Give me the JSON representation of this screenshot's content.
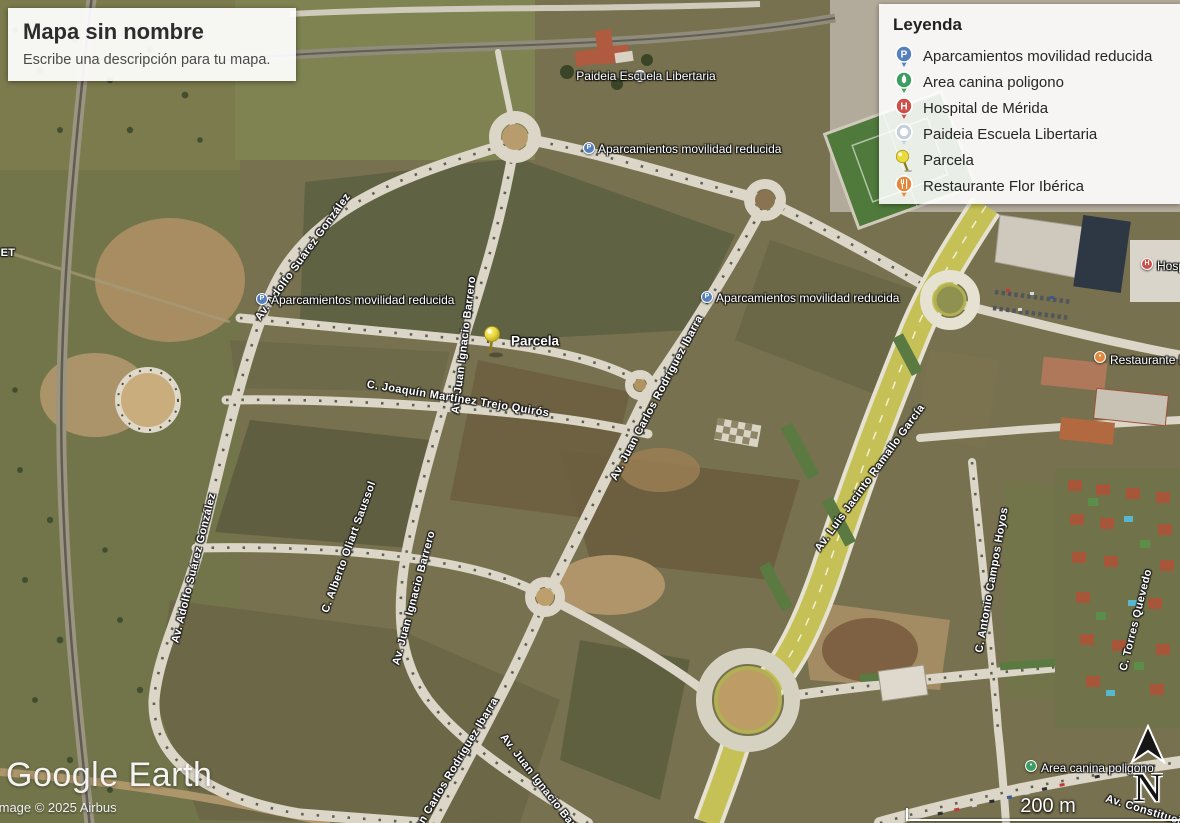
{
  "title_card": {
    "title": "Mapa sin nombre",
    "subtitle": "Escribe una descripción para tu mapa."
  },
  "legend": {
    "heading": "Leyenda",
    "items": [
      {
        "icon": "parking-marker",
        "color": "#5580bd",
        "label": "Aparcamientos movilidad reducida"
      },
      {
        "icon": "dog-park-marker",
        "color": "#3d9e63",
        "label": "Area canina poligono"
      },
      {
        "icon": "hospital-marker",
        "color": "#cc4f4a",
        "label": "Hospital de Mérida"
      },
      {
        "icon": "school-marker",
        "color": "#c2d0da",
        "label": "Paideia Escuela Libertaria"
      },
      {
        "icon": "pushpin",
        "color": "#ecd93c",
        "label": "Parcela"
      },
      {
        "icon": "restaurant-marker",
        "color": "#e2873b",
        "label": "Restaurante Flor Ibérica"
      }
    ]
  },
  "map_labels": {
    "poi": [
      {
        "text": "Paideia Escuela Libertaria",
        "marker": "school",
        "color": "#c2d0da",
        "glyph": "•",
        "mx": 640,
        "my": 76,
        "tx": 646,
        "ty": 76,
        "align": "center",
        "big": false
      },
      {
        "text": "Aparcamientos movilidad reducida",
        "marker": "parking",
        "color": "#5580bd",
        "glyph": "P",
        "mx": 589,
        "my": 148,
        "tx": 598,
        "ty": 149,
        "align": "left",
        "big": false
      },
      {
        "text": "Aparcamientos movilidad reducida",
        "marker": "parking",
        "color": "#5580bd",
        "glyph": "P",
        "mx": 262,
        "my": 299,
        "tx": 271,
        "ty": 300,
        "align": "left",
        "big": false
      },
      {
        "text": "Aparcamientos movilidad reducida",
        "marker": "parking",
        "color": "#5580bd",
        "glyph": "P",
        "mx": 707,
        "my": 297,
        "tx": 716,
        "ty": 298,
        "align": "left",
        "big": false
      },
      {
        "text": "Parcela",
        "marker": "pushpin",
        "color": "#ecd93c",
        "glyph": "",
        "mx": 490,
        "my": 343,
        "tx": 511,
        "ty": 341,
        "align": "left",
        "big": true
      },
      {
        "text": "Area canina poligono",
        "marker": "dog",
        "color": "#3d9e63",
        "glyph": "•",
        "mx": 1031,
        "my": 766,
        "tx": 1041,
        "ty": 768,
        "align": "left",
        "big": false
      },
      {
        "text": "Hospital de Mérida",
        "marker": "hospital",
        "color": "#cc4f4a",
        "glyph": "H",
        "mx": 1147,
        "my": 264,
        "tx": 1157,
        "ty": 266,
        "align": "left",
        "big": false
      },
      {
        "text": "Restaurante Flor Ibérica",
        "marker": "restaurant",
        "color": "#e2873b",
        "glyph": "•",
        "mx": 1100,
        "my": 357,
        "tx": 1110,
        "ty": 360,
        "align": "left",
        "big": false
      }
    ],
    "streets": [
      {
        "text": "Av. Adolfo Suárez González",
        "x": 303,
        "y": 257,
        "rot": -54
      },
      {
        "text": "Av. Adolfo Suárez González",
        "x": 194,
        "y": 568,
        "rot": -76
      },
      {
        "text": "Av. Juan Ignacio Barrero",
        "x": 464,
        "y": 345,
        "rot": -83
      },
      {
        "text": "C. Joaquín Martínez Trejo Quirós",
        "x": 458,
        "y": 399,
        "rot": 9
      },
      {
        "text": "Av. Juan Carlos Rodríguez Ibarra",
        "x": 657,
        "y": 398,
        "rot": -62
      },
      {
        "text": "Av. Luis Jacinto Ramallo García",
        "x": 870,
        "y": 478,
        "rot": -54
      },
      {
        "text": "C. Alberto Oliart Saussol",
        "x": 349,
        "y": 547,
        "rot": -70
      },
      {
        "text": "Av. Juan Ignacio Barrero",
        "x": 414,
        "y": 598,
        "rot": -75
      },
      {
        "text": "Av. Juan Carlos Rodríguez Ibarra",
        "x": 448,
        "y": 778,
        "rot": -59
      },
      {
        "text": "Av. Juan Ignacio Barrero",
        "x": 545,
        "y": 790,
        "rot": 52
      },
      {
        "text": "C. Antonio Campos Hoyos",
        "x": 992,
        "y": 580,
        "rot": -80
      },
      {
        "text": "C. Torres Quevedo",
        "x": 1136,
        "y": 620,
        "rot": -76
      },
      {
        "text": "Av. Constitución",
        "x": 1150,
        "y": 812,
        "rot": 17
      },
      {
        "text": "ET",
        "x": 8,
        "y": 253,
        "rot": 0
      }
    ]
  },
  "attribution": {
    "logo_text": "Google Earth",
    "copyright": "Image © 2025 Airbus"
  },
  "scale": {
    "label": "200 m"
  },
  "compass": {
    "label": "N"
  }
}
